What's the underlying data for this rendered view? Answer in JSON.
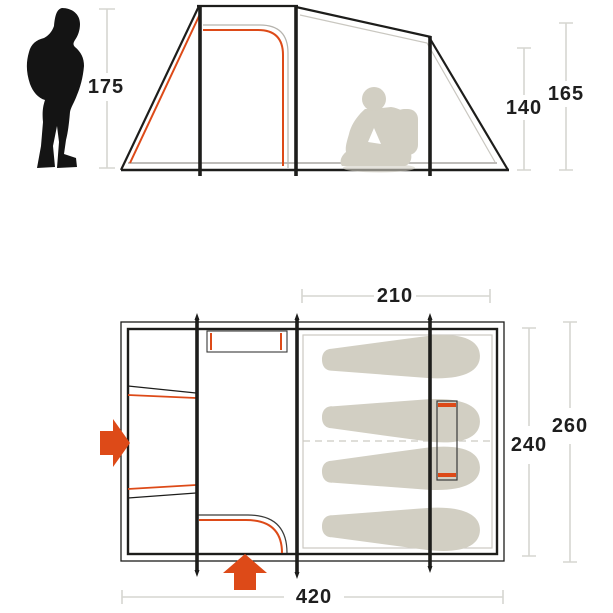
{
  "labels": {
    "person_height": "175",
    "inner_height": "140",
    "peak_height": "165",
    "bedroom_width": "210",
    "bedroom_depth": "240",
    "tent_depth": "260",
    "tent_length": "420"
  },
  "colors": {
    "accent_orange": "#dd4a18",
    "line_black": "#1d1d1b",
    "silhouette_black": "#141414",
    "silhouette_gray": "#d2cfc3",
    "dim_line_gray": "#d6d6d1",
    "label_text": "#1e1e1e",
    "background": "#ffffff"
  },
  "icons": {
    "standing_person": "standing-hiker-silhouette",
    "sitting_person": "sitting-camper-silhouette",
    "left_entrance_arrow": "arrow-right",
    "front_entrance_arrow": "arrow-up"
  }
}
